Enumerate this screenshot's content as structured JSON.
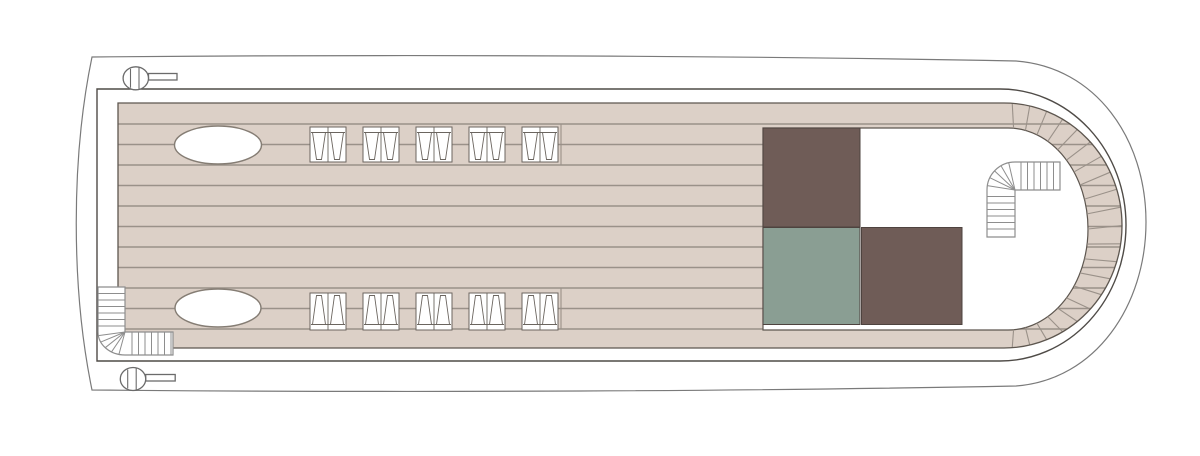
{
  "meta": {
    "title": "Sun deck floor plan",
    "diagram_type": "ship-deck-plan"
  },
  "palette": {
    "page_bg": "#ffffff",
    "hull_fill": "#ffffff",
    "hull_stroke": "#7a7a7a",
    "platform_fill": "#ffffff",
    "platform_stroke": "#4f4b47",
    "deck_fill": "#dcd0c7",
    "deck_stroke": "#5d564f",
    "plank_line": "#9a9189",
    "interior_fill": "#ffffff",
    "interior_stroke": "#5d564f",
    "block_brown": "#6f5c57",
    "block_green": "#8a9e93",
    "block_stroke": "#4e433f",
    "furniture_stroke": "#857d74",
    "lounger_stroke": "#6b655f",
    "stair_stroke": "#8e8e8e",
    "bollard_stroke": "#6b6b6b"
  },
  "deck": {
    "plank_span": {
      "x1": 118,
      "x2": 1122
    },
    "plank_lines_y": [
      124,
      144.5,
      165,
      185.5,
      206,
      226.5,
      247,
      267.5,
      288,
      308.5,
      329
    ],
    "butt_joints": [
      {
        "x": 561,
        "y1": 124,
        "y2": 165
      },
      {
        "x": 561,
        "y1": 288,
        "y2": 329
      }
    ],
    "curve_joints": {
      "theta_start": -86,
      "theta_end": 86,
      "count": 21,
      "inner": {
        "cx": 1008,
        "cy": 229,
        "rx": 80,
        "ry": 101
      },
      "outer": {
        "cx": 1004,
        "cy": 225.5,
        "rx": 118,
        "ry": 122.5
      }
    }
  },
  "features": {
    "skylights": [
      {
        "name": "skylight-top",
        "cx": 218,
        "cy": 145,
        "rx": 43.5,
        "ry": 19
      },
      {
        "name": "skylight-bottom",
        "cx": 218,
        "cy": 308,
        "rx": 43,
        "ry": 19
      }
    ],
    "lounger_rows": [
      {
        "name": "lounger-row-top",
        "orientation": "head-top",
        "y": 127,
        "w": 36,
        "h": 35,
        "xs": [
          310,
          363,
          416,
          469,
          522
        ]
      },
      {
        "name": "lounger-row-bottom",
        "orientation": "head-bottom",
        "y": 293,
        "w": 36,
        "h": 37,
        "xs": [
          310,
          363,
          416,
          469,
          522
        ]
      }
    ],
    "blocks": [
      {
        "name": "deckhouse-block-top",
        "x": 763,
        "y": 128,
        "w": 97,
        "h": 99,
        "color": "brown"
      },
      {
        "name": "deckhouse-block-green",
        "x": 763,
        "y": 227.5,
        "w": 97,
        "h": 97,
        "color": "green"
      },
      {
        "name": "deckhouse-block-bottom",
        "x": 861.5,
        "y": 227.5,
        "w": 100.5,
        "h": 97,
        "color": "brown"
      }
    ],
    "stairs": [
      {
        "name": "stairs-port-aft",
        "outline": "M98,287 L125,287 L125,332 L173,332 L173,355 L125,355 A27,23 0 0 1 98,332 Z",
        "v_steps": {
          "x1": 98,
          "x2": 125,
          "ys": [
            293.5,
            300,
            306.5,
            313,
            319.5,
            326
          ]
        },
        "h_steps": {
          "y1": 332,
          "y2": 355,
          "xs": [
            132,
            138.5,
            145,
            151.5,
            158,
            164.5,
            171
          ]
        },
        "fan": {
          "pivot": [
            125,
            332
          ],
          "rx": 27,
          "ry": 23,
          "angles": [
            103,
            120,
            137,
            154,
            171
          ]
        }
      },
      {
        "name": "stairs-starboard-forward",
        "outline": "M1060,162 L1015,162 A28,28 0 0 0 987,190 L987,237 L1015,237 L1015,190 L1060,190 Z",
        "h_steps": {
          "y1": 162,
          "y2": 190,
          "xs": [
            1021,
            1027.5,
            1034,
            1040.5,
            1047,
            1053.5
          ]
        },
        "v_steps": {
          "x1": 987,
          "x2": 1015,
          "ys": [
            196.5,
            203,
            209.5,
            216,
            222.5,
            229
          ]
        },
        "fan": {
          "pivot": [
            1015,
            190
          ],
          "rx": 28,
          "ry": 28,
          "angles": [
            189,
            206,
            223,
            240,
            257
          ]
        }
      }
    ],
    "bollards": [
      {
        "name": "bollard-top",
        "cx": 135.8,
        "cy": 78.3,
        "rx": 12.7,
        "ry": 11.5,
        "handle": {
          "x": 148.5,
          "y": 73.5,
          "w": 28.5,
          "h": 6.5
        }
      },
      {
        "name": "bollard-bottom",
        "cx": 133,
        "cy": 379,
        "rx": 12.7,
        "ry": 11.5,
        "handle": {
          "x": 145.7,
          "y": 374.5,
          "w": 29.5,
          "h": 6.5
        }
      }
    ]
  }
}
